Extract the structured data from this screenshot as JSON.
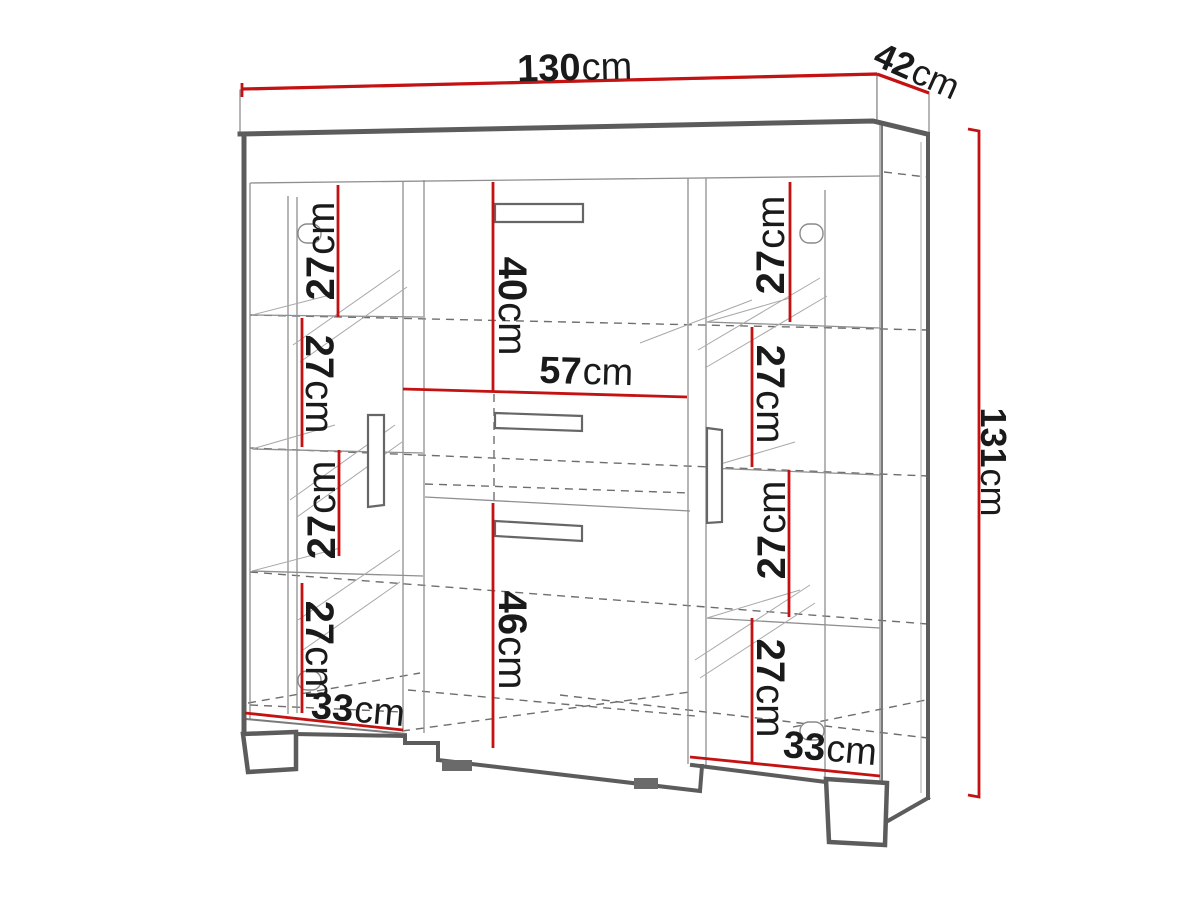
{
  "diagram_title": "cabinet-dimension-diagram",
  "measurements": {
    "width": {
      "value": "130",
      "unit": "cm"
    },
    "depth": {
      "value": "42",
      "unit": "cm"
    },
    "height": {
      "value": "131",
      "unit": "cm"
    },
    "center_top_section_height": {
      "value": "40",
      "unit": "cm"
    },
    "center_section_width": {
      "value": "57",
      "unit": "cm"
    },
    "center_bottom_section_height": {
      "value": "46",
      "unit": "cm"
    },
    "left_door_sections": [
      {
        "value": "27",
        "unit": "cm"
      },
      {
        "value": "27",
        "unit": "cm"
      },
      {
        "value": "27",
        "unit": "cm"
      },
      {
        "value": "27",
        "unit": "cm"
      }
    ],
    "left_door_shelf_width": {
      "value": "33",
      "unit": "cm"
    },
    "right_door_sections": [
      {
        "value": "27",
        "unit": "cm"
      },
      {
        "value": "27",
        "unit": "cm"
      },
      {
        "value": "27",
        "unit": "cm"
      },
      {
        "value": "27",
        "unit": "cm"
      }
    ],
    "right_door_shelf_width": {
      "value": "33",
      "unit": "cm"
    }
  },
  "colors": {
    "dimension_line": "#c41212",
    "outline": "#5c5c5c",
    "detail_line": "#8f8f8f",
    "hidden_line": "#6e6e6e",
    "label_text": "#1a1a1a",
    "background": "#ffffff"
  }
}
